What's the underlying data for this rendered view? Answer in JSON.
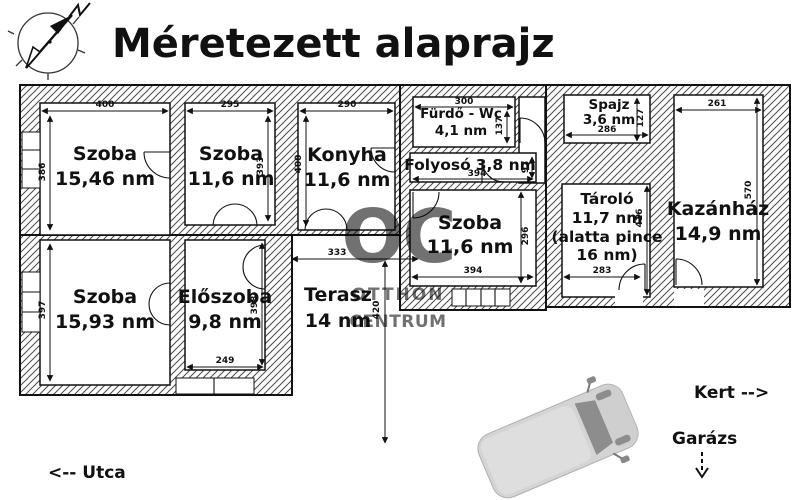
{
  "title": "Méretezett alaprajz",
  "watermark": {
    "logo": "OC",
    "line1": "OTTHON",
    "line2": "CENTRUM"
  },
  "rooms": [
    {
      "label": "Szoba",
      "area": "15,46 nm",
      "dim_top": "400",
      "dim_side": "386"
    },
    {
      "label": "Szoba",
      "area": "11,6 nm",
      "dim_top": "295",
      "dim_side": "393"
    },
    {
      "label": "Konyha",
      "area": "11,6 nm",
      "dim_top": "290",
      "dim_side": "400"
    },
    {
      "label": "Fürdő - Wc",
      "area": "4,1 nm",
      "dim_top": "300",
      "dim_side": "137"
    },
    {
      "label": "Folyosó",
      "area": "3,8 nm",
      "dim_bottom": "394",
      "dim_side": "97"
    },
    {
      "label": "Szoba",
      "area": "11,6 nm",
      "dim_bottom": "394",
      "dim_side": "296"
    },
    {
      "label": "Spajz",
      "area": "3,6 nm",
      "dim_bottom": "286",
      "dim_side": "127"
    },
    {
      "label": "Tároló",
      "area": "11,7 nm",
      "note_line1": "(alatta pince",
      "note_line2": "16 nm)",
      "dim_bottom": "283",
      "dim_side": "416"
    },
    {
      "label": "Kazánház",
      "area": "14,9 nm",
      "dim_top": "261",
      "dim_side": "570"
    },
    {
      "label": "Szoba",
      "area": "15,93 nm",
      "dim_side": "397"
    },
    {
      "label": "Előszoba",
      "area": "9,8 nm",
      "dim_bottom": "249",
      "dim_side": "398"
    },
    {
      "label": "Terasz",
      "area": "14 nm",
      "dim_top": "333",
      "dim_side": "420"
    }
  ],
  "annotations": {
    "kert": "Kert -->",
    "garazs": "Garázs",
    "utca": "<-- Utca"
  },
  "colors": {
    "line": "#1a1a1a",
    "watermark": "#b5b5b5",
    "car_body": "#d4d4d4",
    "car_glass": "#8d8d8d"
  }
}
